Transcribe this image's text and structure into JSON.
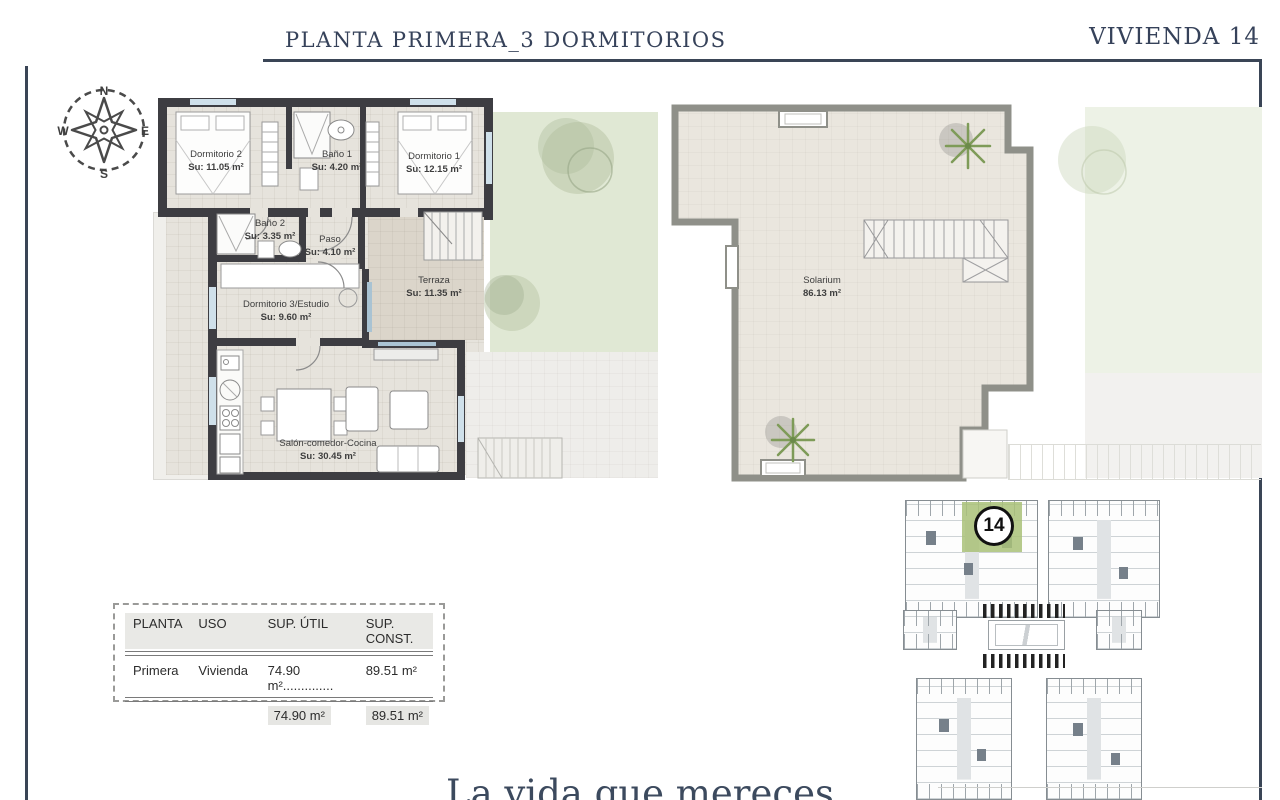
{
  "header": {
    "title": "PLANTA PRIMERA_3 DORMITORIOS",
    "unit": "VIVIENDA 14"
  },
  "compass": {
    "n": "N",
    "e": "E",
    "s": "S",
    "w": "W"
  },
  "floor_plan": {
    "rooms": [
      {
        "name": "Dormitorio 2",
        "area": "Su: 11.05 m²"
      },
      {
        "name": "Baño 1",
        "area": "Su: 4.20 m²"
      },
      {
        "name": "Dormitorio 1",
        "area": "Su: 12.15 m²"
      },
      {
        "name": "Baño 2",
        "area": "Su: 3.35 m²"
      },
      {
        "name": "Paso",
        "area": "Su: 4.10 m²"
      },
      {
        "name": "Dormitorio 3/Estudio",
        "area": "Su: 9.60 m²"
      },
      {
        "name": "Terraza",
        "area": "Su: 11.35 m²"
      },
      {
        "name": "Salón-comedor-Cocina",
        "area": "Su: 30.45 m²"
      }
    ]
  },
  "solarium_plan": {
    "room": {
      "name": "Solarium",
      "area": "86.13 m²"
    }
  },
  "areas_table": {
    "headers": [
      "PLANTA",
      "USO",
      "SUP. ÚTIL",
      "SUP. CONST."
    ],
    "row": {
      "planta": "Primera",
      "uso": "Vivienda",
      "sup_util": "74.90 m²",
      "leader": "..............",
      "sup_const": "89.51 m²"
    },
    "totals": {
      "sup_util": "74.90 m²",
      "sup_const": "89.51 m²"
    }
  },
  "site_plan": {
    "unit_label": "14"
  },
  "footer": {
    "tagline": "La vida que mereces"
  },
  "colors": {
    "accent_navy": "#36425a",
    "wall_dark": "#3d3d42",
    "wall_gray": "#8f9089",
    "garden_green": "#e0e8d4",
    "unit_highlight": "#a9c178",
    "floor_tile": "#e6e3dc",
    "solarium_tile": "#eae6de"
  }
}
